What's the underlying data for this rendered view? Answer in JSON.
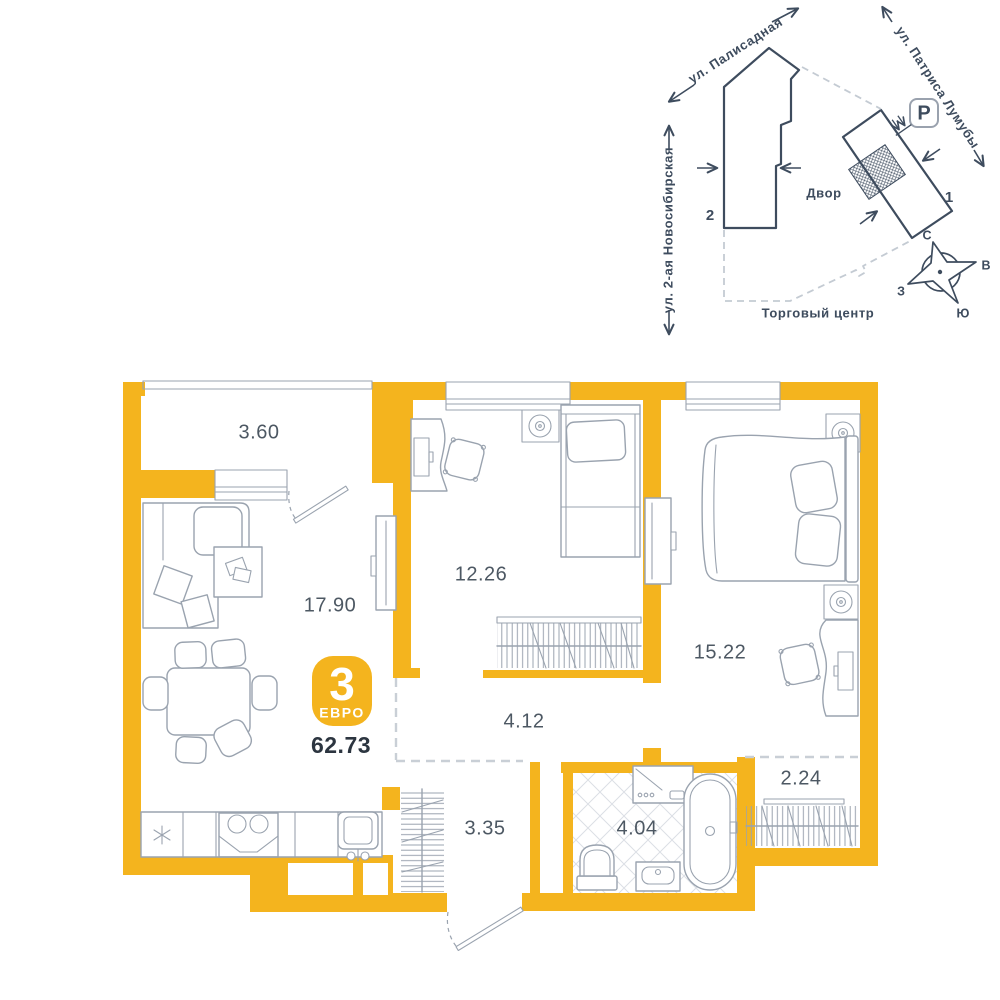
{
  "badge": {
    "rooms_count": "3",
    "type_label": "ЕВРО",
    "total_area": "62.73"
  },
  "rooms": {
    "balcony": "3.60",
    "living_kitchen": "17.90",
    "bedroom_1": "12.26",
    "bedroom_2": "15.22",
    "hallway": "4.12",
    "wardrobe_niche": "2.24",
    "corridor": "3.35",
    "bathroom": "4.04"
  },
  "site_plan": {
    "streets": {
      "palisadnaya": "ул. Палисадная",
      "patrisa_lumumby": "ул. Патриса Лумубы",
      "novosibirskaya": "ул. 2-ая Новосибирская"
    },
    "yard_label": "Двор",
    "mall_label": "Торговый центр",
    "building_1": "1",
    "building_2": "2",
    "parking_label": "P",
    "compass": {
      "north": "С",
      "east": "В",
      "south": "Ю",
      "west": "З"
    }
  },
  "colors": {
    "wall": "#F4B41E",
    "plan_line": "#3E4C5E",
    "furniture_line": "#9AA3AF",
    "dash_line": "#C9CFD6",
    "label": "#4D5863",
    "dark_text": "#2C3540"
  }
}
